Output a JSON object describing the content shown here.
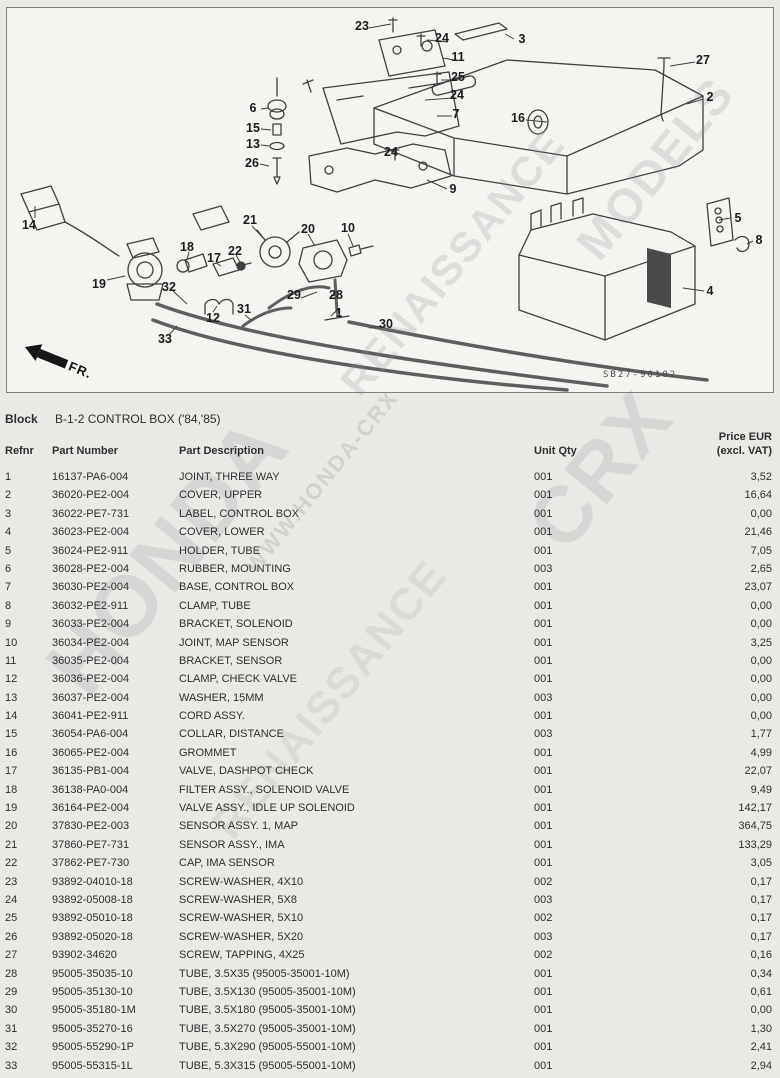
{
  "colors": {
    "page_bg": "#e9e9e6",
    "diagram_bg": "#f4f4f1",
    "diagram_border": "#7f7f7f",
    "text": "#2e2e2e",
    "watermark": "#8f8f8f"
  },
  "diagram": {
    "code": "SB27-90102",
    "fr_label": "FR.",
    "callouts": [
      {
        "label": "23",
        "x": 355,
        "y": 18
      },
      {
        "label": "24",
        "x": 435,
        "y": 30
      },
      {
        "label": "11",
        "x": 451,
        "y": 49
      },
      {
        "label": "25",
        "x": 451,
        "y": 69
      },
      {
        "label": "24",
        "x": 450,
        "y": 87
      },
      {
        "label": "7",
        "x": 449,
        "y": 106
      },
      {
        "label": "24",
        "x": 384,
        "y": 144
      },
      {
        "label": "9",
        "x": 446,
        "y": 181
      },
      {
        "label": "3",
        "x": 515,
        "y": 31
      },
      {
        "label": "27",
        "x": 696,
        "y": 52
      },
      {
        "label": "2",
        "x": 703,
        "y": 89
      },
      {
        "label": "16",
        "x": 511,
        "y": 110
      },
      {
        "label": "6",
        "x": 246,
        "y": 100
      },
      {
        "label": "15",
        "x": 246,
        "y": 120
      },
      {
        "label": "13",
        "x": 246,
        "y": 136
      },
      {
        "label": "26",
        "x": 245,
        "y": 155
      },
      {
        "label": "14",
        "x": 22,
        "y": 217
      },
      {
        "label": "19",
        "x": 92,
        "y": 276
      },
      {
        "label": "18",
        "x": 180,
        "y": 239
      },
      {
        "label": "17",
        "x": 207,
        "y": 250
      },
      {
        "label": "21",
        "x": 243,
        "y": 212
      },
      {
        "label": "22",
        "x": 228,
        "y": 243
      },
      {
        "label": "20",
        "x": 301,
        "y": 221
      },
      {
        "label": "10",
        "x": 341,
        "y": 220
      },
      {
        "label": "32",
        "x": 162,
        "y": 279
      },
      {
        "label": "12",
        "x": 206,
        "y": 310
      },
      {
        "label": "31",
        "x": 237,
        "y": 301
      },
      {
        "label": "29",
        "x": 287,
        "y": 287
      },
      {
        "label": "28",
        "x": 329,
        "y": 287
      },
      {
        "label": "1",
        "x": 332,
        "y": 305
      },
      {
        "label": "33",
        "x": 158,
        "y": 331
      },
      {
        "label": "30",
        "x": 379,
        "y": 316
      },
      {
        "label": "5",
        "x": 731,
        "y": 210
      },
      {
        "label": "8",
        "x": 752,
        "y": 232
      },
      {
        "label": "4",
        "x": 703,
        "y": 283
      }
    ]
  },
  "watermarks": [
    {
      "text": "MODELS",
      "x": 655,
      "y": 168,
      "size": 48,
      "opacity": 0.22
    },
    {
      "text": "RENAISSANCE",
      "x": 452,
      "y": 262,
      "size": 42,
      "opacity": 0.22
    },
    {
      "text": "CRX",
      "x": 600,
      "y": 470,
      "size": 80,
      "opacity": 0.2
    },
    {
      "text": "WWW.HONDA-CRX",
      "x": 322,
      "y": 482,
      "size": 22,
      "opacity": 0.26
    },
    {
      "text": "HONDA",
      "x": 168,
      "y": 556,
      "size": 86,
      "opacity": 0.2
    },
    {
      "text": "RENAISSANCE",
      "x": 330,
      "y": 700,
      "size": 44,
      "opacity": 0.16
    }
  ],
  "block": {
    "label": "Block",
    "title": "B-1-2 CONTROL BOX ('84,'85)"
  },
  "table": {
    "headers": {
      "refnr": "Refnr",
      "part_number": "Part Number",
      "description": "Part Description",
      "qty": "Unit Qty",
      "price_line1": "Price EUR",
      "price_line2": "(excl. VAT)"
    },
    "rows": [
      {
        "refnr": "1",
        "part_number": "16137-PA6-004",
        "description": "JOINT, THREE WAY",
        "qty": "001",
        "price": "3,52"
      },
      {
        "refnr": "2",
        "part_number": "36020-PE2-004",
        "description": "COVER, UPPER",
        "qty": "001",
        "price": "16,64"
      },
      {
        "refnr": "3",
        "part_number": "36022-PE7-731",
        "description": "LABEL, CONTROL BOX",
        "qty": "001",
        "price": "0,00"
      },
      {
        "refnr": "4",
        "part_number": "36023-PE2-004",
        "description": "COVER, LOWER",
        "qty": "001",
        "price": "21,46"
      },
      {
        "refnr": "5",
        "part_number": "36024-PE2-911",
        "description": "HOLDER, TUBE",
        "qty": "001",
        "price": "7,05"
      },
      {
        "refnr": "6",
        "part_number": "36028-PE2-004",
        "description": "RUBBER, MOUNTING",
        "qty": "003",
        "price": "2,65"
      },
      {
        "refnr": "7",
        "part_number": "36030-PE2-004",
        "description": "BASE, CONTROL BOX",
        "qty": "001",
        "price": "23,07"
      },
      {
        "refnr": "8",
        "part_number": "36032-PE2-911",
        "description": "CLAMP, TUBE",
        "qty": "001",
        "price": "0,00"
      },
      {
        "refnr": "9",
        "part_number": "36033-PE2-004",
        "description": "BRACKET, SOLENOID",
        "qty": "001",
        "price": "0,00"
      },
      {
        "refnr": "10",
        "part_number": "36034-PE2-004",
        "description": "JOINT, MAP SENSOR",
        "qty": "001",
        "price": "3,25"
      },
      {
        "refnr": "11",
        "part_number": "36035-PE2-004",
        "description": "BRACKET, SENSOR",
        "qty": "001",
        "price": "0,00"
      },
      {
        "refnr": "12",
        "part_number": "36036-PE2-004",
        "description": "CLAMP, CHECK VALVE",
        "qty": "001",
        "price": "0,00"
      },
      {
        "refnr": "13",
        "part_number": "36037-PE2-004",
        "description": "WASHER, 15MM",
        "qty": "003",
        "price": "0,00"
      },
      {
        "refnr": "14",
        "part_number": "36041-PE2-911",
        "description": "CORD ASSY.",
        "qty": "001",
        "price": "0,00"
      },
      {
        "refnr": "15",
        "part_number": "36054-PA6-004",
        "description": "COLLAR, DISTANCE",
        "qty": "003",
        "price": "1,77"
      },
      {
        "refnr": "16",
        "part_number": "36065-PE2-004",
        "description": "GROMMET",
        "qty": "001",
        "price": "4,99"
      },
      {
        "refnr": "17",
        "part_number": "36135-PB1-004",
        "description": "VALVE, DASHPOT CHECK",
        "qty": "001",
        "price": "22,07"
      },
      {
        "refnr": "18",
        "part_number": "36138-PA0-004",
        "description": "FILTER ASSY., SOLENOID VALVE",
        "qty": "001",
        "price": "9,49"
      },
      {
        "refnr": "19",
        "part_number": "36164-PE2-004",
        "description": "VALVE ASSY., IDLE UP SOLENOID",
        "qty": "001",
        "price": "142,17"
      },
      {
        "refnr": "20",
        "part_number": "37830-PE2-003",
        "description": "SENSOR ASSY. 1, MAP",
        "qty": "001",
        "price": "364,75"
      },
      {
        "refnr": "21",
        "part_number": "37860-PE7-731",
        "description": "SENSOR ASSY., IMA",
        "qty": "001",
        "price": "133,29"
      },
      {
        "refnr": "22",
        "part_number": "37862-PE7-730",
        "description": "CAP, IMA SENSOR",
        "qty": "001",
        "price": "3,05"
      },
      {
        "refnr": "23",
        "part_number": "93892-04010-18",
        "description": "SCREW-WASHER, 4X10",
        "qty": "002",
        "price": "0,17"
      },
      {
        "refnr": "24",
        "part_number": "93892-05008-18",
        "description": "SCREW-WASHER, 5X8",
        "qty": "003",
        "price": "0,17"
      },
      {
        "refnr": "25",
        "part_number": "93892-05010-18",
        "description": "SCREW-WASHER, 5X10",
        "qty": "002",
        "price": "0,17"
      },
      {
        "refnr": "26",
        "part_number": "93892-05020-18",
        "description": "SCREW-WASHER, 5X20",
        "qty": "003",
        "price": "0,17"
      },
      {
        "refnr": "27",
        "part_number": "93902-34620",
        "description": "SCREW, TAPPING, 4X25",
        "qty": "002",
        "price": "0,16"
      },
      {
        "refnr": "28",
        "part_number": "95005-35035-10",
        "description": "TUBE, 3.5X35 (95005-35001-10M)",
        "qty": "001",
        "price": "0,34"
      },
      {
        "refnr": "29",
        "part_number": "95005-35130-10",
        "description": "TUBE, 3.5X130 (95005-35001-10M)",
        "qty": "001",
        "price": "0,61"
      },
      {
        "refnr": "30",
        "part_number": "95005-35180-1M",
        "description": "TUBE, 3.5X180 (95005-35001-10M)",
        "qty": "001",
        "price": "0,00"
      },
      {
        "refnr": "31",
        "part_number": "95005-35270-16",
        "description": "TUBE, 3.5X270 (95005-35001-10M)",
        "qty": "001",
        "price": "1,30"
      },
      {
        "refnr": "32",
        "part_number": "95005-55290-1P",
        "description": "TUBE, 5.3X290 (95005-55001-10M)",
        "qty": "001",
        "price": "2,41"
      },
      {
        "refnr": "33",
        "part_number": "95005-55315-1L",
        "description": "TUBE, 5.3X315 (95005-55001-10M)",
        "qty": "001",
        "price": "2,94"
      }
    ]
  }
}
